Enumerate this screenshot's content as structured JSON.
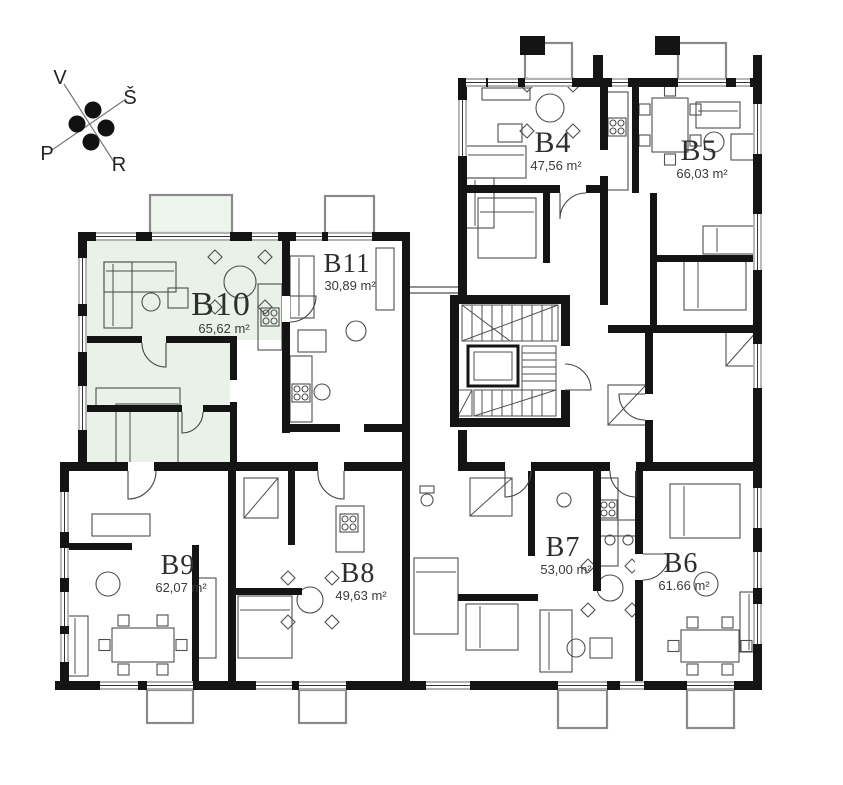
{
  "plan": {
    "type": "apartment-floor-plan",
    "highlighted_unit": "B10"
  },
  "compass": {
    "nw": "V",
    "ne": "Š",
    "sw": "P",
    "se": "R"
  },
  "units": [
    {
      "id": "B4",
      "area": "47,56 m²",
      "x": 553,
      "y": 152,
      "size": 30,
      "highlighted": false
    },
    {
      "id": "B5",
      "area": "66,03 m²",
      "x": 699,
      "y": 160,
      "size": 30,
      "highlighted": false
    },
    {
      "id": "B6",
      "area": "61.66 m²",
      "x": 681,
      "y": 572,
      "size": 28,
      "highlighted": false
    },
    {
      "id": "B7",
      "area": "53,00 m²",
      "x": 563,
      "y": 556,
      "size": 28,
      "highlighted": false
    },
    {
      "id": "B8",
      "area": "49,63 m²",
      "x": 358,
      "y": 582,
      "size": 28,
      "highlighted": false
    },
    {
      "id": "B9",
      "area": "62,07 m²",
      "x": 178,
      "y": 574,
      "size": 28,
      "highlighted": false
    },
    {
      "id": "B10",
      "area": "65,62 m²",
      "x": 221,
      "y": 315,
      "size": 34,
      "highlighted": true
    },
    {
      "id": "B11",
      "area": "30,89 m²",
      "x": 347,
      "y": 272,
      "size": 27,
      "highlighted": false
    }
  ],
  "colors": {
    "wall": "#141414",
    "line": "#4f4f4f",
    "thin": "#8a8a8a",
    "highlight": "#e9f1e9",
    "highlight_balcony": "#eef4ee",
    "text": "#2e2e2e",
    "area_text": "#3a3a3a"
  }
}
